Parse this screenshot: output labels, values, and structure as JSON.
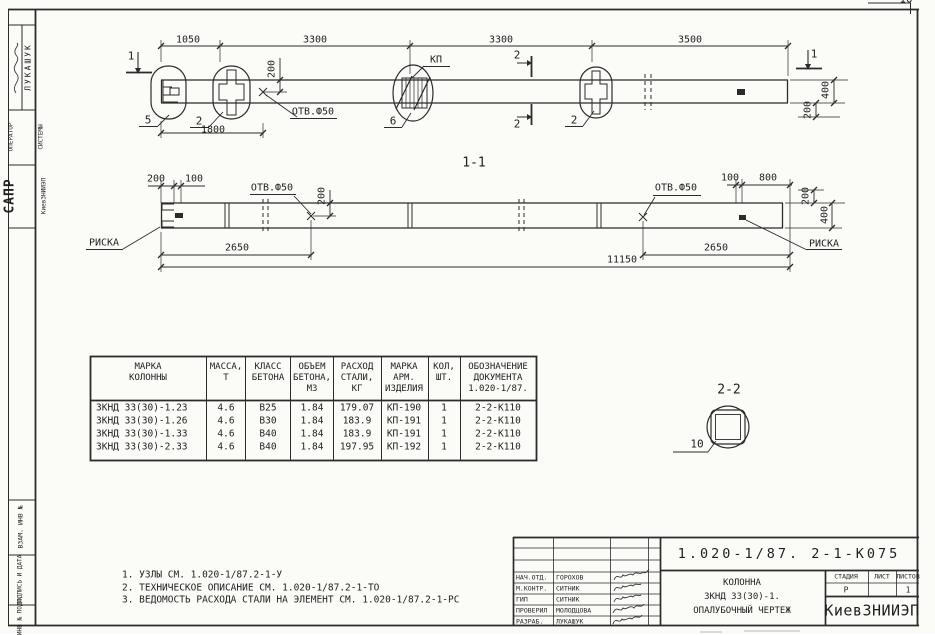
{
  "colors": {
    "ink": "#1f1f1f",
    "paper": "#fbfbf8"
  },
  "corner_mark": "10",
  "sidebar": {
    "author": "ЛУКАШУК",
    "role_line1": "ОПЕРАТОР",
    "role_line2": "СИСТЕМЫ",
    "org_big": "САПР",
    "org_small": "КиевЗНИИЭП",
    "cell_vzam": "ВЗАМ. ИНВ №",
    "cell_podpis": "ПОДПИСЬ И ДАТА",
    "cell_inv": "ИНВ № ПОДЛ"
  },
  "elevation": {
    "dims": {
      "seg1": "1050",
      "seg2": "3300",
      "seg3": "3300",
      "seg4": "3500",
      "overlap": "1800",
      "hole_offset": "200",
      "end_depth": "400",
      "end_half": "200"
    },
    "hole_label": "ОТВ.Ф50",
    "kp_label": "КП",
    "callout_left_end": "5",
    "callout_insert_left": "2",
    "callout_kp": "6",
    "callout_insert_right": "2",
    "section_mark_1": "1",
    "section_mark_2": "2"
  },
  "section_1_1": {
    "title": "1-1",
    "dims": {
      "left_200": "200",
      "left_100": "100",
      "hole_offset": "200",
      "span_left": "2650",
      "right_100": "100",
      "right_800": "800",
      "span_right": "2650",
      "total": "11150",
      "end_200": "200",
      "end_400": "400"
    },
    "hole_label": "ОТВ.Ф50",
    "riska": "РИСКА"
  },
  "section_2_2": {
    "title": "2-2",
    "callout": "10"
  },
  "table": {
    "headers": [
      [
        "МАРКА",
        "КОЛОННЫ"
      ],
      [
        "МАССА,",
        "Т"
      ],
      [
        "КЛАСС",
        "БЕТОНА"
      ],
      [
        "ОБЪЕМ",
        "БЕТОНА,",
        "М3"
      ],
      [
        "РАСХОД",
        "СТАЛИ,",
        "КГ"
      ],
      [
        "МАРКА",
        "АРМ.",
        "ИЗДЕЛИЯ"
      ],
      [
        "КОЛ,",
        "ШТ."
      ],
      [
        "ОБОЗНАЧЕНИЕ",
        "ДОКУМЕНТА",
        "1.020-1/87."
      ]
    ],
    "rows": [
      [
        "ЗКНД 33(30)-1.23",
        "4.6",
        "В25",
        "1.84",
        "179.07",
        "КП-190",
        "1",
        "2-2-К110"
      ],
      [
        "ЗКНД 33(30)-1.26",
        "4.6",
        "В30",
        "1.84",
        "183.9",
        "КП-191",
        "1",
        "2-2-К110"
      ],
      [
        "ЗКНД 33(30)-1.33",
        "4.6",
        "В40",
        "1.84",
        "183.9",
        "КП-191",
        "1",
        "2-2-К110"
      ],
      [
        "ЗКНД 33(30)-2.33",
        "4.6",
        "В40",
        "1.84",
        "197.95",
        "КП-192",
        "1",
        "2-2-К110"
      ]
    ]
  },
  "notes": [
    "1. УЗЛЫ СМ. 1.020-1/87.2-1-У",
    "2. ТЕХНИЧЕСКОЕ ОПИСАНИЕ СМ. 1.020-1/87.2-1-ТО",
    "3. ВЕДОМОСТЬ РАСХОДА СТАЛИ НА ЭЛЕМЕНТ СМ. 1.020-1/87.2-1-РС"
  ],
  "title_block": {
    "doc_number": "1.020-1/87. 2-1-К075",
    "rows": [
      {
        "role": "НАЧ.ОТД.",
        "name": "ГОРОХОВ"
      },
      {
        "role": "М.КОНТР.",
        "name": "СИТНИК"
      },
      {
        "role": "ГИП",
        "name": "СИТНИК"
      },
      {
        "role": "ПРОВЕРИЛ",
        "name": "МОЛОДЦОВА"
      },
      {
        "role": "РАЗРАБ.",
        "name": "ЛУКАШУК"
      }
    ],
    "subject": [
      "КОЛОННА",
      "ЗКНД 33(30)-1.",
      "ОПАЛУБОЧНЫЙ ЧЕРТЕЖ"
    ],
    "stage_label": "СТАДИЯ",
    "sheet_label": "ЛИСТ",
    "sheets_label": "ЛИСТОВ",
    "stage": "Р",
    "sheets": "1",
    "org": "КиевЗНИИЭП"
  }
}
